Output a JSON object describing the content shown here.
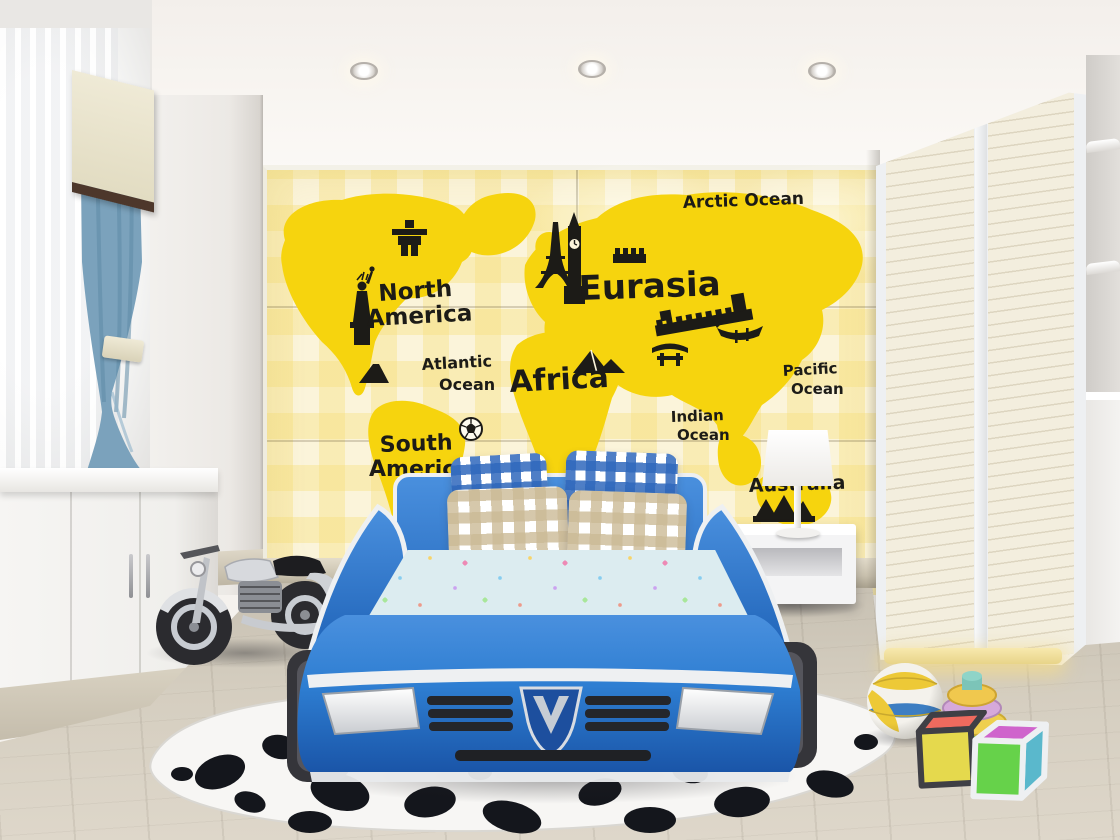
{
  "scene": {
    "type": "rendered-photo",
    "description": "Children's bedroom with yellow world-map mural wall, blue race-car bed, cow-print rug, toy motorcycle, wardrobe and toys"
  },
  "mural": {
    "labels": {
      "arctic_ocean": "Arctic Ocean",
      "north_america_line1": "North",
      "north_america_line2": "America",
      "atlantic_ocean_line1": "Atlantic",
      "atlantic_ocean_line2": "Ocean",
      "south_america_line1": "South",
      "south_america_line2": "America",
      "africa": "Africa",
      "eurasia": "Eurasia",
      "indian_ocean_line1": "Indian",
      "indian_ocean_line2": "Ocean",
      "pacific_ocean_line1": "Pacific",
      "pacific_ocean_line2": "Ocean",
      "australia": "Australia"
    },
    "landmark_icons": [
      "inukshuk-icon",
      "statue-of-liberty-icon",
      "volcano-icon",
      "soccer-ball-icon",
      "eiffel-tower-icon",
      "big-ben-icon",
      "kremlin-wall-icon",
      "great-wall-icon",
      "pagoda-gate-icon",
      "dragon-boat-icon",
      "pyramids-icon",
      "sydney-opera-house-icon"
    ],
    "colors": {
      "map_yellow": "#f6d40e",
      "wall_cream": "#fbf4da",
      "plaid_yellow": "#f7e39b",
      "decal_black": "#1c1b17"
    }
  },
  "furniture_colors": {
    "bed_blue": "#2e7ed2",
    "bed_blue_dark": "#1c5cb0",
    "bed_trim_white": "#eef0f2",
    "mattress_blue": "#dcecf0",
    "pillow_gingham_blue": "#2f68bc",
    "pillow_gingham_beige": "#cbba96",
    "curtain_blue": "#7ba2bc",
    "valance_cream": "#efead6",
    "rug_white": "#f7f6f4",
    "cow_spot_black": "#14161c",
    "floor_wood": "#d5cec0",
    "wardrobe_cream": "#f3eede",
    "warm_light": "#f0dc8f"
  },
  "toy_colors": {
    "volleyball_yellow": "#edc937",
    "volleyball_blue": "#3d7ec2",
    "ring_green": "#72bf5a",
    "ring_yellow": "#eecf4e",
    "ring_pink": "#d6a9da",
    "ring_teal": "#8fd4c8",
    "block_red": "#ef6a5e",
    "block_yellow": "#e5d94d",
    "block_magenta": "#cf64cc",
    "block_green": "#66d24a",
    "block_teal": "#5ab8cc"
  }
}
